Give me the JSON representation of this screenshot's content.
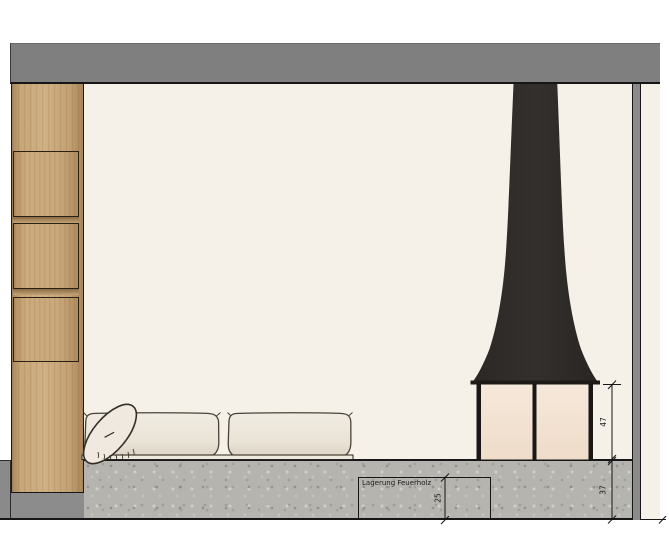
{
  "drawing": {
    "type": "interior-elevation",
    "labels": {
      "firewood_storage": "Lagerung Feuerholz"
    },
    "dimensions": {
      "firebox_opening_height": "47",
      "plinth_height": "37",
      "firewood_storage_height": "25"
    },
    "palette": {
      "ceiling_beam": "#7f7f7f",
      "wall_cut": "#8b8b8b",
      "wood": "#c9a97c",
      "concrete": "#b5b4af",
      "room_background": "#f5f1e8",
      "fireplace": "#2e2b28",
      "firebox_glow": "#f4e3d3",
      "cushion": "#ece7dd",
      "line": "#161616"
    }
  }
}
